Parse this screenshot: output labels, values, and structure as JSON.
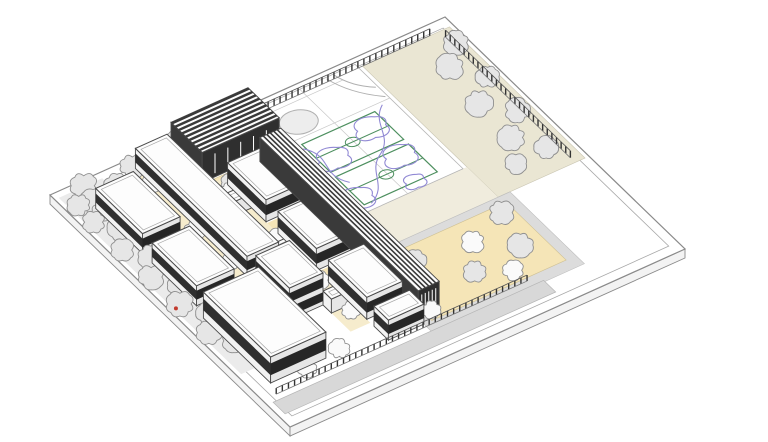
{
  "canvas": {
    "width": 768,
    "height": 442,
    "background": "#ffffff"
  },
  "projection": {
    "origin": [
      445,
      17
    ],
    "aVec": [
      -395,
      178
    ],
    "bVec": [
      240,
      232
    ],
    "slabDepth": 9
  },
  "palette": {
    "line": "#4a4a4a",
    "lineLight": "#a8a8a8",
    "siteEdge": "#8a8a8a",
    "treeFill": "#e6e6e6",
    "treeFillLight": "#fafafa",
    "treeStroke": "#8f8f8f",
    "trunk": "#6f6f6f",
    "tan": "#f5e5b7",
    "tanLight": "#f6eccd",
    "beige": "#eae6d3",
    "beigeLight": "#f0ecdd",
    "pathGray": "#ebebeb",
    "walkGray": "#d8d8d8",
    "plazaEdge": "#dcdcdc",
    "courtGreen": "#4d8f5f",
    "playPurple": "#9189d4",
    "curveGray": "#b0b0b0",
    "courtLine": "#c8c8c8",
    "roofWhite": "#fdfdfd",
    "wallLight": "#f2f2f2",
    "wallShade": "#e6e6e6",
    "darkBand": "#2f2f2f",
    "ribDark": "#3a3a3a",
    "slab": "#f3f3f3",
    "fencePost": "#333333",
    "fenceRail": "#555555",
    "fenceBase": "#777777",
    "accentRed": "#c23b2e",
    "white": "#ffffff"
  },
  "scene": {
    "grounds": [
      {
        "name": "site-slab-top",
        "rect": [
          0,
          1,
          0,
          1
        ],
        "fill": "#ffffff",
        "stroke": "#8a8a8a",
        "sw": 1.2
      },
      {
        "name": "sidewalk-inner-line",
        "rect": [
          0.023,
          0.977,
          0.03,
          0.97
        ],
        "fill": "none",
        "stroke": "#a8a8a8",
        "sw": 0.8
      },
      {
        "name": "planting-strip-northeast",
        "rect": [
          0.01,
          0.23,
          0.035,
          0.6
        ],
        "fill": "#eae6d3",
        "stroke": "#c9c5b2",
        "sw": 0.6
      },
      {
        "name": "walk-between-courts-and-plaza",
        "rect": [
          0.23,
          0.52,
          0.47,
          0.6
        ],
        "fill": "#f0ecdd",
        "stroke": "none",
        "sw": 0
      },
      {
        "name": "plaza-edge-paths",
        "rect": [
          0.2,
          0.585,
          0.6,
          0.91
        ],
        "fill": "#dcdcdc",
        "stroke": "#bdbdbd",
        "sw": 0.6
      },
      {
        "name": "east-tan-plaza",
        "rect": [
          0.225,
          0.565,
          0.625,
          0.875
        ],
        "fill": "#f5e5b7",
        "stroke": "#cfc194",
        "sw": 0.6
      },
      {
        "name": "gym-courtyard-plaza",
        "rect": [
          0.52,
          0.7,
          0.17,
          0.345
        ],
        "fill": "#f5e5b7",
        "stroke": "#cfc194",
        "sw": 0.6
      },
      {
        "name": "courtyard-strip-mid",
        "rect": [
          0.675,
          0.725,
          0.18,
          0.8
        ],
        "fill": "#f6eccd",
        "stroke": "none",
        "sw": 0
      },
      {
        "name": "courtyard-strip-west",
        "rect": [
          0.805,
          0.85,
          0.04,
          0.55
        ],
        "fill": "#f6eccd",
        "stroke": "none",
        "sw": 0
      },
      {
        "name": "courtyard-pocket-1",
        "rect": [
          0.585,
          0.675,
          0.37,
          0.41
        ],
        "fill": "#f5e5b7",
        "stroke": "none",
        "sw": 0
      },
      {
        "name": "courtyard-pocket-2",
        "rect": [
          0.585,
          0.675,
          0.58,
          0.62
        ],
        "fill": "#f5e5b7",
        "stroke": "none",
        "sw": 0
      },
      {
        "name": "west-tree-path",
        "rect": [
          0.88,
          0.99,
          0.02,
          0.78
        ],
        "fill": "#ebebeb",
        "stroke": "none",
        "sw": 0
      },
      {
        "name": "southeast-service-walk",
        "rect": [
          0.3,
          0.985,
          0.905,
          0.955
        ],
        "fill": "#d8d8d8",
        "stroke": "#b5b5b5",
        "sw": 0.7
      },
      {
        "name": "sports-court-ground",
        "rect": [
          0.24,
          0.52,
          0.02,
          0.47
        ],
        "fill": "#ffffff",
        "stroke": "#b5b5b5",
        "sw": 0.8
      }
    ],
    "courts": {
      "green_courts": [
        {
          "rect": [
            0.29,
            0.475,
            0.185,
            0.305
          ]
        },
        {
          "rect": [
            0.29,
            0.475,
            0.325,
            0.445
          ]
        }
      ],
      "gray_circle": {
        "c": [
          0.44,
          0.115
        ],
        "r": 0.042
      },
      "gray_arcs": [
        "M0.245 0.155 Q0.30 0.10 0.315 0.025",
        "M0.245 0.115 Q0.285 0.08 0.295 0.025"
      ],
      "light_lines": [
        "M0.38 0.02 L0.38 0.47",
        "M0.24 0.165 L0.52 0.165",
        "M0.29 0.05 L0.475 0.05"
      ],
      "purple_paths": [
        "M0.30 0.20 C0.325 0.175 0.36 0.19 0.355 0.22 C0.38 0.235 0.365 0.27 0.335 0.262 C0.315 0.278 0.288 0.262 0.295 0.238 C0.28 0.222 0.285 0.208 0.30 0.20 Z",
        "M0.30 0.32 C0.325 0.295 0.36 0.31 0.355 0.34 C0.38 0.355 0.365 0.39 0.335 0.382 C0.315 0.398 0.288 0.382 0.295 0.358 C0.28 0.342 0.285 0.328 0.30 0.32 Z",
        "M0.42 0.24 C0.445 0.215 0.48 0.23 0.475 0.26 C0.50 0.275 0.485 0.31 0.455 0.302 C0.435 0.318 0.408 0.302 0.415 0.278 C0.40 0.262 0.405 0.248 0.42 0.24 Z",
        "M0.45 0.39 C0.475 0.365 0.51 0.38 0.505 0.41 C0.53 0.425 0.515 0.46 0.485 0.452 C0.465 0.468 0.438 0.452 0.445 0.428 C0.43 0.412 0.435 0.398 0.45 0.39 Z",
        "M0.33 0.425 C0.35 0.41 0.37 0.42 0.365 0.44 C0.38 0.45 0.37 0.47 0.35 0.465 C0.335 0.475 0.318 0.462 0.325 0.445 C0.318 0.435 0.322 0.428 0.33 0.425 Z",
        "M0.265 0.175 C0.32 0.22 0.30 0.28 0.36 0.32 C0.41 0.355 0.40 0.42 0.46 0.45",
        "M0.48 0.20 C0.44 0.26 0.50 0.30 0.46 0.36"
      ],
      "center_circle_r": 0.016
    },
    "fences": [
      {
        "name": "fence-northwest",
        "from": [
          0.06,
          0.035
        ],
        "to": [
          0.56,
          0.035
        ],
        "posts": 34,
        "h": 7
      },
      {
        "name": "fence-northeast",
        "from": [
          0.035,
          0.06
        ],
        "to": [
          0.035,
          0.58
        ],
        "posts": 28,
        "h": 7
      },
      {
        "name": "fence-southeast",
        "from": [
          0.33,
          0.885
        ],
        "to": [
          0.965,
          0.885
        ],
        "posts": 42,
        "h": 6
      }
    ],
    "buildings": [
      {
        "name": "gym-hall",
        "a": [
          0.52,
          0.715
        ],
        "b": [
          0.035,
          0.165
        ],
        "h": 30,
        "style": "ribbed"
      },
      {
        "name": "gym-annex",
        "a": [
          0.715,
          0.775
        ],
        "b": [
          0.035,
          0.105
        ],
        "h": 12,
        "style": "plain"
      },
      {
        "name": "louvered-spine-building",
        "a": [
          0.525,
          0.578
        ],
        "b": [
          0.18,
          0.84
        ],
        "h": 24,
        "style": "louver"
      },
      {
        "name": "classroom-block-a1",
        "a": [
          0.585,
          0.675
        ],
        "b": [
          0.205,
          0.365
        ],
        "h": 22,
        "style": "banded"
      },
      {
        "name": "classroom-block-a2",
        "a": [
          0.585,
          0.675
        ],
        "b": [
          0.415,
          0.575
        ],
        "h": 22,
        "style": "banded"
      },
      {
        "name": "classroom-block-a3",
        "a": [
          0.585,
          0.675
        ],
        "b": [
          0.625,
          0.785
        ],
        "h": 22,
        "style": "banded"
      },
      {
        "name": "classroom-block-a4",
        "a": [
          0.585,
          0.675
        ],
        "b": [
          0.815,
          0.875
        ],
        "h": 20,
        "style": "banded"
      },
      {
        "name": "link-corridor-1",
        "a": [
          0.675,
          0.725
        ],
        "b": [
          0.27,
          0.305
        ],
        "h": 14,
        "style": "plain"
      },
      {
        "name": "link-corridor-2",
        "a": [
          0.675,
          0.725
        ],
        "b": [
          0.48,
          0.515
        ],
        "h": 14,
        "style": "plain"
      },
      {
        "name": "link-corridor-3",
        "a": [
          0.675,
          0.725
        ],
        "b": [
          0.685,
          0.72
        ],
        "h": 14,
        "style": "plain"
      },
      {
        "name": "northwest-wing",
        "a": [
          0.725,
          0.805
        ],
        "b": [
          0.035,
          0.5
        ],
        "h": 20,
        "style": "banded"
      },
      {
        "name": "two-story-block",
        "a": [
          0.725,
          0.81
        ],
        "b": [
          0.545,
          0.685
        ],
        "h": 32,
        "style": "two-story"
      },
      {
        "name": "classroom-block-c1",
        "a": [
          0.85,
          0.945
        ],
        "b": [
          0.1,
          0.295
        ],
        "h": 20,
        "style": "banded"
      },
      {
        "name": "classroom-block-c2",
        "a": [
          0.85,
          0.945
        ],
        "b": [
          0.335,
          0.52
        ],
        "h": 20,
        "style": "banded"
      },
      {
        "name": "south-hall-block",
        "a": [
          0.815,
          0.955
        ],
        "b": [
          0.565,
          0.845
        ],
        "h": 26,
        "style": "banded"
      }
    ],
    "trees": [
      [
        0.585,
        0.055,
        12,
        "g"
      ],
      [
        0.645,
        0.085,
        11,
        "g"
      ],
      [
        0.705,
        0.05,
        13,
        "g"
      ],
      [
        0.765,
        0.09,
        11,
        "g"
      ],
      [
        0.825,
        0.055,
        12,
        "g"
      ],
      [
        0.885,
        0.09,
        12,
        "g"
      ],
      [
        0.945,
        0.05,
        13,
        "g"
      ],
      [
        0.985,
        0.095,
        11,
        "g"
      ],
      [
        0.77,
        0.14,
        10,
        "g"
      ],
      [
        0.86,
        0.145,
        11,
        "g"
      ],
      [
        0.95,
        0.14,
        10,
        "g"
      ],
      [
        0.955,
        0.105,
        12,
        "g"
      ],
      [
        0.99,
        0.165,
        11,
        "g"
      ],
      [
        0.955,
        0.225,
        13,
        "g"
      ],
      [
        0.99,
        0.285,
        11,
        "g"
      ],
      [
        0.955,
        0.345,
        12,
        "g"
      ],
      [
        0.99,
        0.405,
        12,
        "g"
      ],
      [
        0.955,
        0.465,
        11,
        "g"
      ],
      [
        0.99,
        0.525,
        13,
        "g"
      ],
      [
        0.955,
        0.585,
        11,
        "g"
      ],
      [
        0.99,
        0.645,
        12,
        "g"
      ],
      [
        0.96,
        0.7,
        11,
        "g"
      ],
      [
        0.045,
        0.12,
        12,
        "g"
      ],
      [
        0.1,
        0.185,
        13,
        "g"
      ],
      [
        0.05,
        0.26,
        11,
        "g"
      ],
      [
        0.115,
        0.33,
        13,
        "g"
      ],
      [
        0.06,
        0.4,
        12,
        "g"
      ],
      [
        0.12,
        0.475,
        13,
        "g"
      ],
      [
        0.075,
        0.545,
        11,
        "g"
      ],
      [
        0.155,
        0.55,
        10,
        "g"
      ],
      [
        0.27,
        0.68,
        12,
        "g"
      ],
      [
        0.37,
        0.725,
        11,
        "w"
      ],
      [
        0.295,
        0.8,
        12,
        "g"
      ],
      [
        0.42,
        0.815,
        11,
        "g"
      ],
      [
        0.35,
        0.86,
        10,
        "w"
      ],
      [
        0.5,
        0.7,
        10,
        "g"
      ],
      [
        0.53,
        0.8,
        10,
        "g"
      ],
      [
        0.56,
        0.865,
        9,
        "w"
      ],
      [
        0.565,
        0.215,
        10,
        "g"
      ],
      [
        0.625,
        0.27,
        11,
        "g"
      ],
      [
        0.68,
        0.225,
        9,
        "g"
      ],
      [
        0.6,
        0.315,
        10,
        "g"
      ],
      [
        0.63,
        0.39,
        9,
        "w"
      ],
      [
        0.63,
        0.6,
        9,
        "w"
      ],
      [
        0.7,
        0.255,
        10,
        "w"
      ],
      [
        0.7,
        0.455,
        10,
        "w"
      ],
      [
        0.7,
        0.63,
        9,
        "w"
      ],
      [
        0.7,
        0.76,
        9,
        "w"
      ],
      [
        0.828,
        0.13,
        10,
        "w"
      ],
      [
        0.828,
        0.32,
        10,
        "w"
      ],
      [
        0.828,
        0.46,
        9,
        "w"
      ],
      [
        0.79,
        0.86,
        10,
        "w"
      ],
      [
        0.88,
        0.875,
        9,
        "w"
      ]
    ],
    "marks": [
      {
        "name": "red-site-marker",
        "pos": [
          0.985,
          0.5
        ],
        "r": 2,
        "color": "#c23b2e"
      }
    ]
  }
}
